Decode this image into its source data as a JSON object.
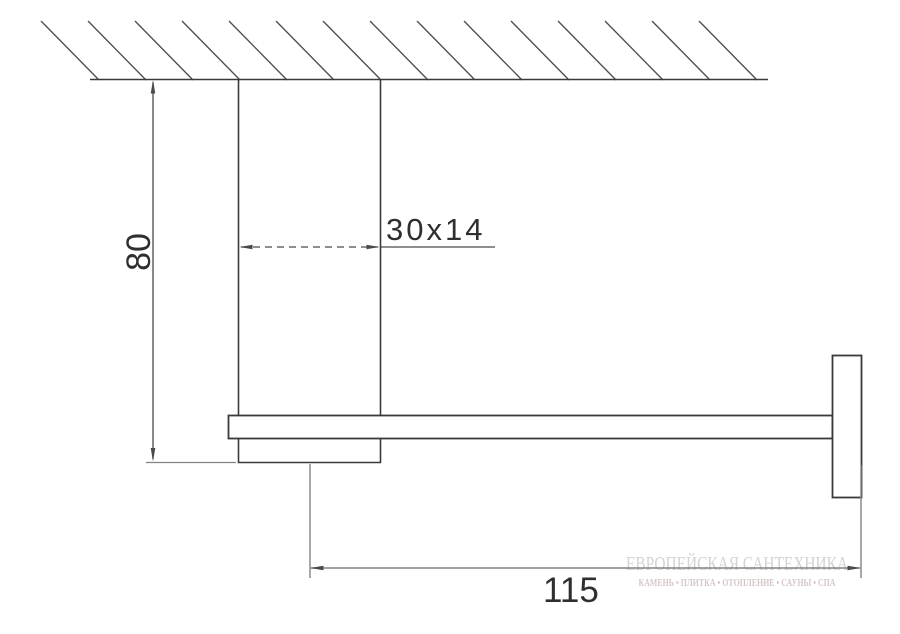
{
  "colors": {
    "background": "#ffffff",
    "object_line": "#3a3a3a",
    "hatch_line": "#4c4c4c",
    "dim_line": "#4a4a4a",
    "dim_line_light": "#828282",
    "dim_text": "#2f2f2f",
    "watermark_title": "#d3d3d3",
    "watermark_subtitle": "#d6c7c7"
  },
  "dimensions": {
    "height": "80",
    "profile": "30x14",
    "depth": "115"
  },
  "watermark": {
    "title": "ЕВРОПЕЙСКАЯ САНТЕХНИКА",
    "subtitle": "КАМЕНЬ • ПЛИТКА • ОТОПЛЕНИЕ • САУНЫ • СПА"
  }
}
